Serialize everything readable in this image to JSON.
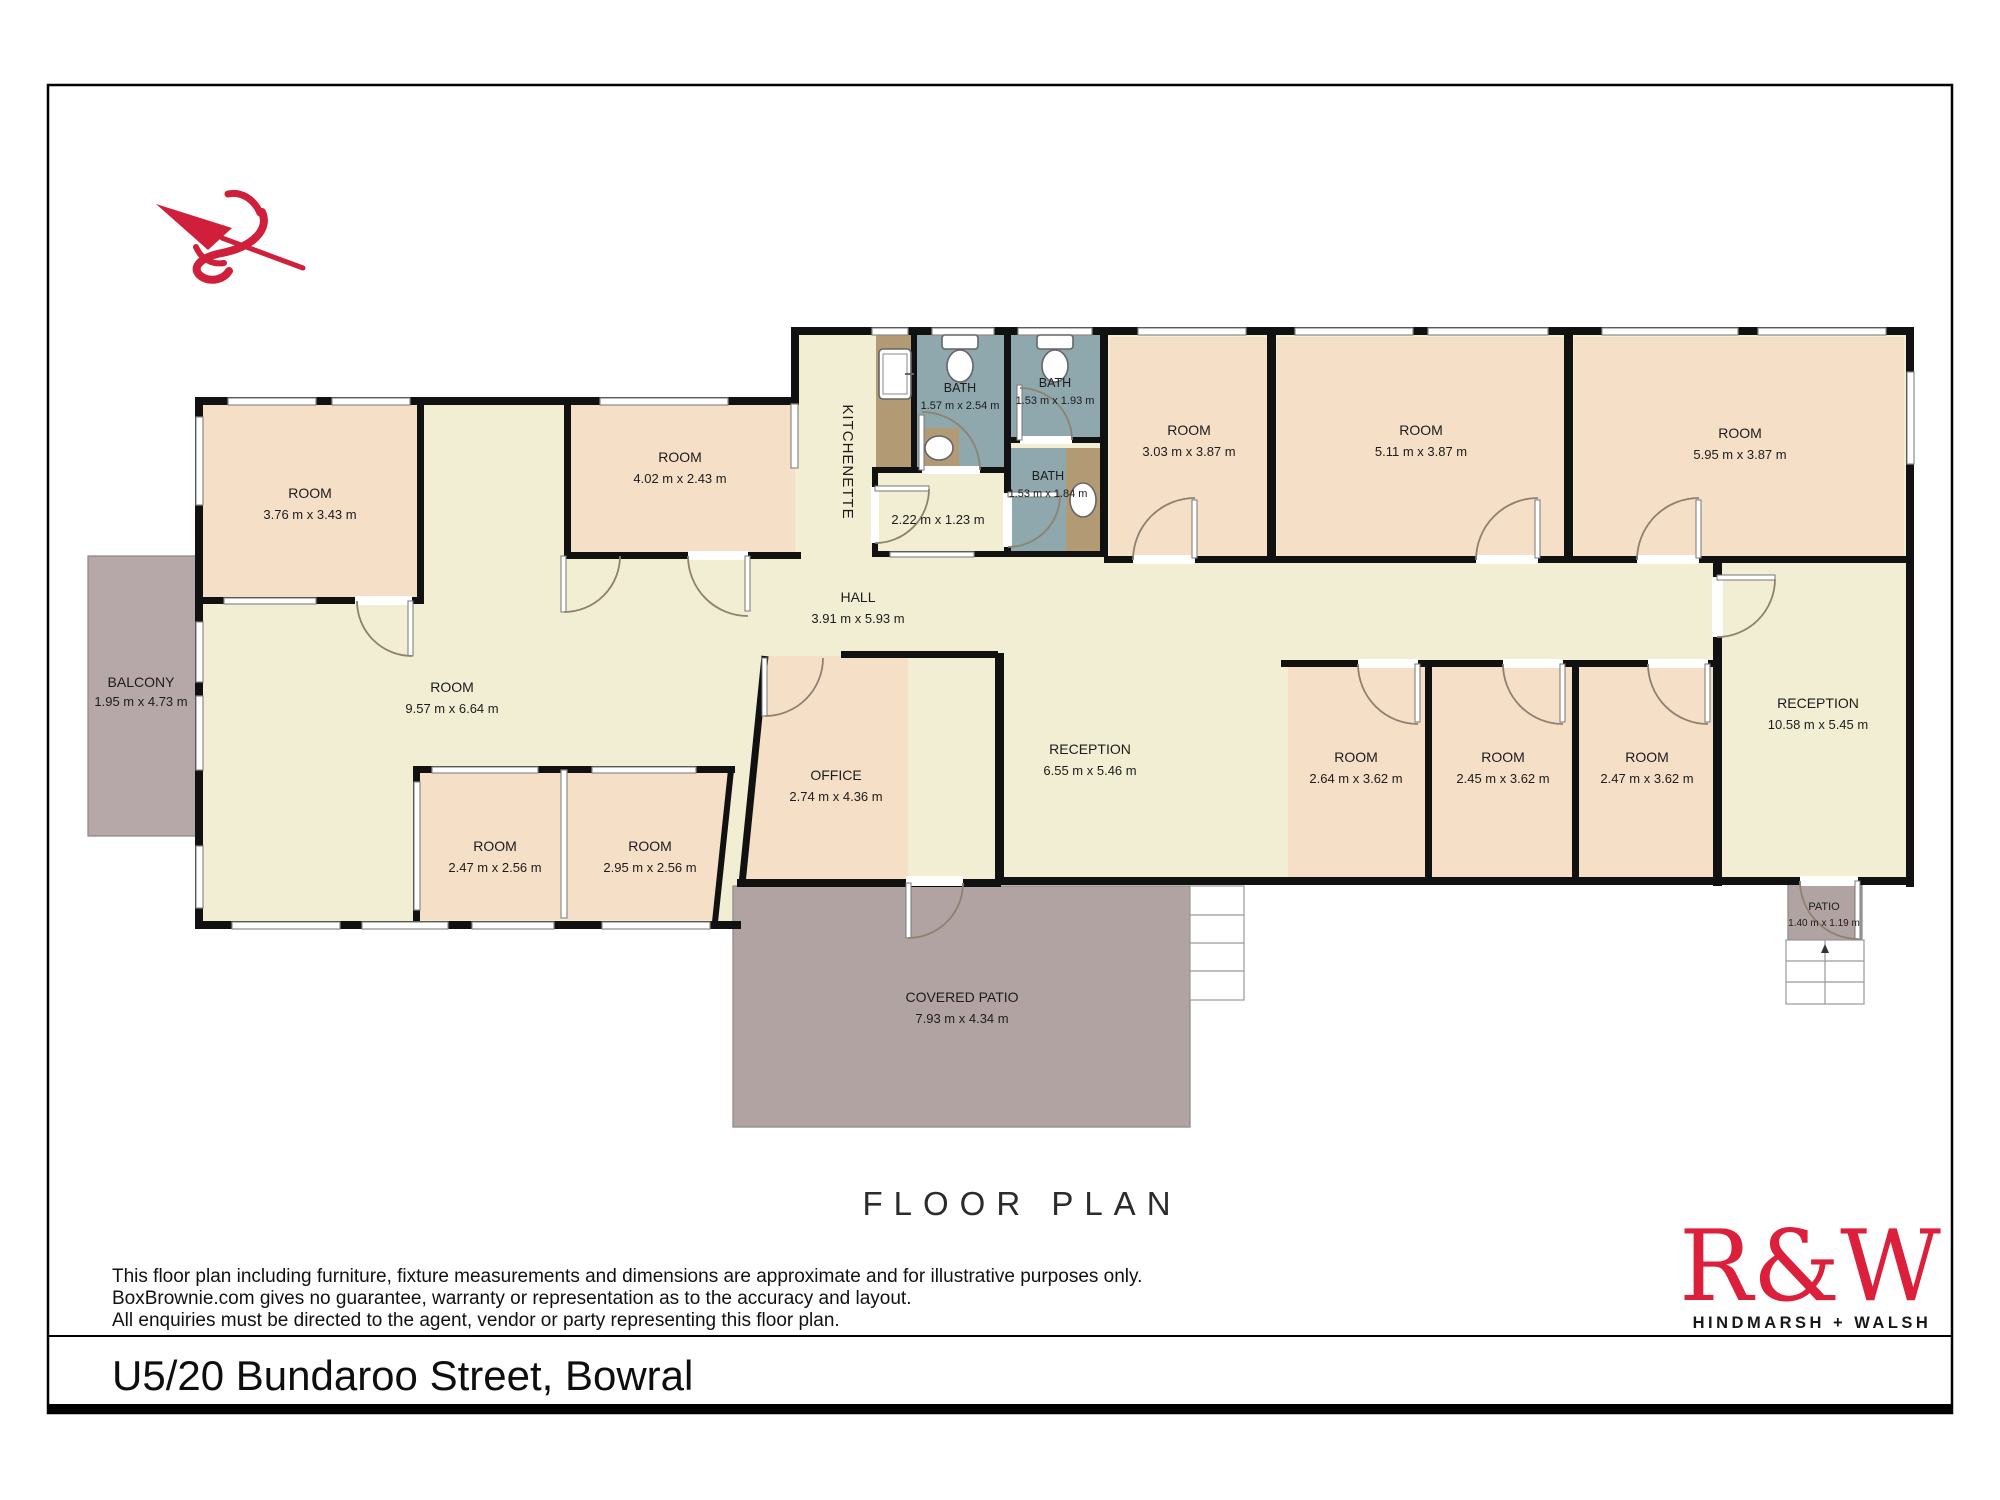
{
  "page": {
    "title": "FLOOR PLAN",
    "address": "U5/20 Bundaroo Street, Bowral",
    "disclaimer": [
      "This floor plan including furniture, fixture measurements and dimensions are approximate and for illustrative purposes only.",
      "BoxBrownie.com gives no guarantee, warranty or representation as to the accuracy and layout.",
      "All enquiries must be directed to the agent, vendor or party representing this floor plan."
    ],
    "logo": {
      "brand": "R&W",
      "sub": "HINDMARSH + WALSH"
    }
  },
  "plan": {
    "north_arrow": "north-arrow",
    "colors": {
      "wall": "#111111",
      "floor_cream": "#f1eed3",
      "floor_peach": "#f5dfc6",
      "floor_bath": "#8ea8ad",
      "counter_brown": "#b29a75",
      "outdoor_mauve": "#b4a5a5",
      "accent_red": "#cf1f3a"
    },
    "rooms": {
      "balcony": {
        "name": "BALCONY",
        "dims": "1.95 m x 4.73 m"
      },
      "room376": {
        "name": "ROOM",
        "dims": "3.76 m x 3.43 m"
      },
      "room402": {
        "name": "ROOM",
        "dims": "4.02 m x 2.43 m"
      },
      "kitchenette": {
        "name": "KITCHENETTE"
      },
      "bath1": {
        "name": "BATH",
        "dims": "1.57 m x 2.54 m"
      },
      "bath2": {
        "name": "BATH",
        "dims": "1.53 m x 1.93 m"
      },
      "bath3": {
        "name": "BATH",
        "dims": "1.53 m x 1.84 m"
      },
      "smallroom": {
        "dims": "2.22 m x 1.23 m"
      },
      "room303": {
        "name": "ROOM",
        "dims": "3.03 m x 3.87 m"
      },
      "room511": {
        "name": "ROOM",
        "dims": "5.11 m x 3.87 m"
      },
      "room595": {
        "name": "ROOM",
        "dims": "5.95 m x 3.87 m"
      },
      "hall": {
        "name": "HALL",
        "dims": "3.91 m x 5.93 m"
      },
      "room957": {
        "name": "ROOM",
        "dims": "9.57 m x 6.64 m"
      },
      "office": {
        "name": "OFFICE",
        "dims": "2.74 m x 4.36 m"
      },
      "reception655": {
        "name": "RECEPTION",
        "dims": "6.55 m x 5.46 m"
      },
      "room264": {
        "name": "ROOM",
        "dims": "2.64 m x 3.62 m"
      },
      "room245": {
        "name": "ROOM",
        "dims": "2.45 m x 3.62 m"
      },
      "room247b": {
        "name": "ROOM",
        "dims": "2.47 m x 3.62 m"
      },
      "reception1058": {
        "name": "RECEPTION",
        "dims": "10.58 m x 5.45 m"
      },
      "room247a": {
        "name": "ROOM",
        "dims": "2.47 m x 2.56 m"
      },
      "room295": {
        "name": "ROOM",
        "dims": "2.95 m x 2.56 m"
      },
      "coveredpatio": {
        "name": "COVERED PATIO",
        "dims": "7.93 m x 4.34 m"
      },
      "patio": {
        "name": "PATIO",
        "dims": "1.40 m x 1.19 m"
      }
    }
  }
}
